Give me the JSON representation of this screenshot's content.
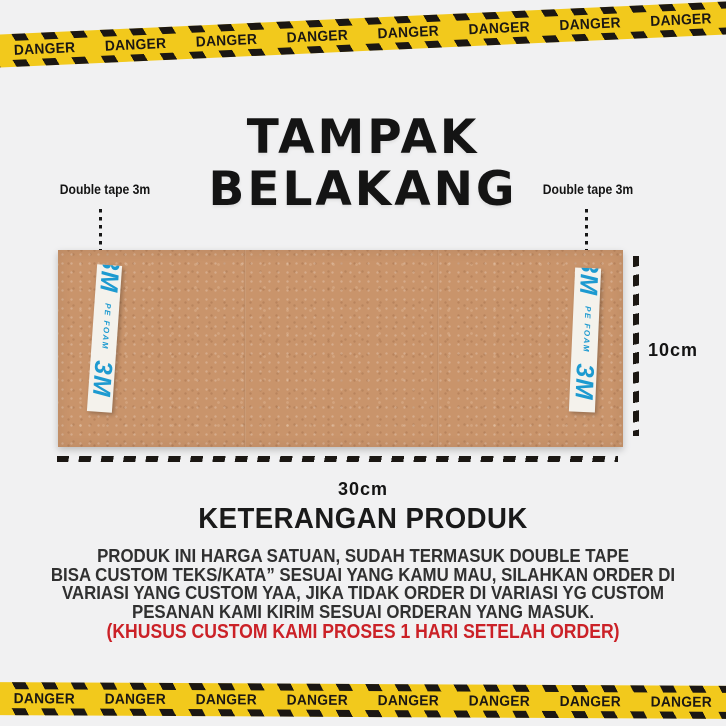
{
  "colors": {
    "background": "#f1f1f2",
    "tape_yellow": "#f2c91c",
    "tape_black": "#1b1713",
    "board_brown": "#c9946b",
    "tape_blue": "#1d9ad0",
    "text_dark": "#303030",
    "title_black": "#141414",
    "note_red": "#cb2127"
  },
  "danger_tape": {
    "label": "DANGER",
    "top_count": 8,
    "bottom_count": 8
  },
  "title": {
    "line1": "TAMPAK",
    "line2": "BELAKANG"
  },
  "annotations": {
    "left_tape_label": "Double tape 3m",
    "right_tape_label": "Double tape 3m",
    "height_label": "10cm",
    "width_label": "30cm"
  },
  "board": {
    "tape_logo": "3M",
    "tape_sub": "PE FOAM"
  },
  "description": {
    "heading": "KETERANGAN PRODUK",
    "lines": [
      "PRODUK INI HARGA SATUAN, SUDAH TERMASUK DOUBLE TAPE",
      "BISA CUSTOM TEKS/KATA” SESUAI YANG KAMU MAU, SILAHKAN ORDER DI",
      "VARIASI YANG CUSTOM YAA, JIKA TIDAK ORDER DI VARIASI YG CUSTOM",
      "PESANAN KAMI KIRIM SESUAI ORDERAN YANG MASUK."
    ],
    "note": "(KHUSUS CUSTOM KAMI PROSES 1 HARI SETELAH ORDER)"
  }
}
